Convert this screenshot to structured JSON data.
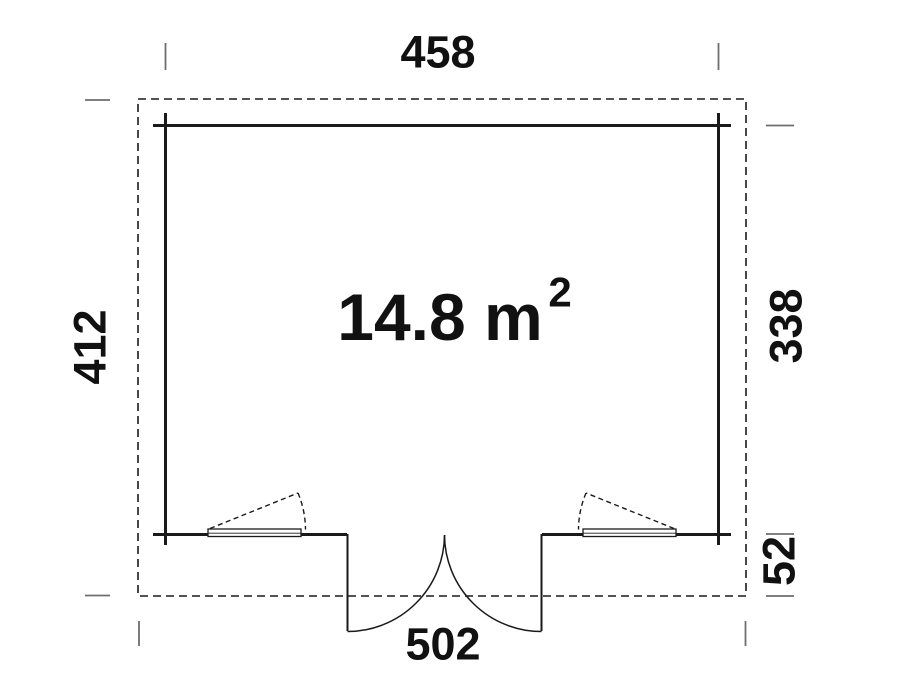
{
  "floor_plan": {
    "area": {
      "value_label": "14.8 m",
      "superscript": "2"
    },
    "dimensions": {
      "inner_width_top": "458",
      "outer_height_left": "412",
      "inner_height_right": "338",
      "overhang_right": "52",
      "outer_width_bottom": "502"
    },
    "colors": {
      "line": "#1a1a1a",
      "tick": "#6e6e6e",
      "background": "#ffffff"
    }
  }
}
